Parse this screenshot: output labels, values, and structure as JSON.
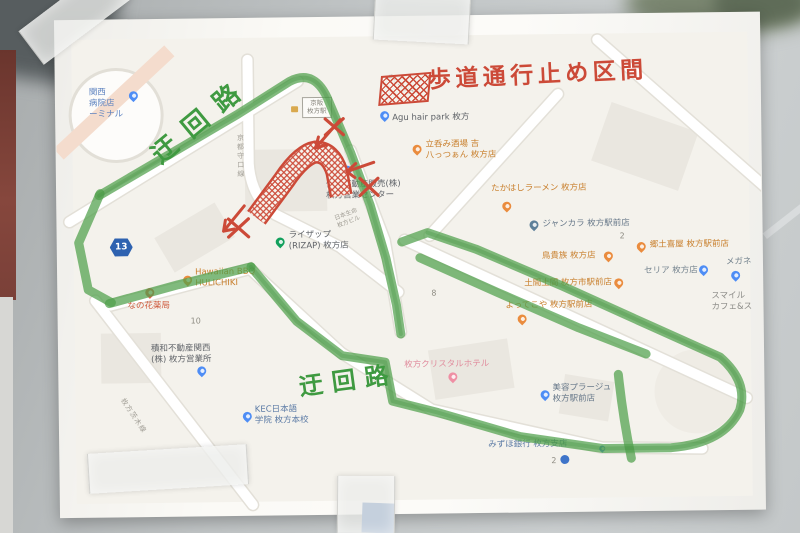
{
  "annotations": {
    "title": "歩道通行止め区間",
    "detour_top": "迂回路",
    "detour_bottom": "迂回路",
    "marker_green": "#4f9f4b",
    "marker_red": "#cc4a38"
  },
  "map": {
    "route_shield": "13",
    "road_names": {
      "keito_moriguchi": "京都守口線",
      "hirakata_ibaraki": "枚方茨木線"
    },
    "station_box": [
      "京阪",
      "枚方駅"
    ],
    "block_numbers": {
      "a": "10",
      "b": "8",
      "c": "2",
      "d": "2"
    },
    "clinic": "クリニック",
    "pois": [
      {
        "id": "terminal",
        "lines": [
          "関西",
          "病院店",
          "ーミナル"
        ]
      },
      {
        "id": "agu-hair-park",
        "lines": [
          "Agu hair park 枚方"
        ]
      },
      {
        "id": "hattsuan",
        "lines": [
          "立呑み酒場 吉",
          "八っつぁん 枚方店"
        ]
      },
      {
        "id": "takahashi-ramen",
        "lines": [
          "たかはしラーメン 枚方店"
        ]
      },
      {
        "id": "jankara",
        "lines": [
          "ジャンカラ 枚方駅前店"
        ]
      },
      {
        "id": "torikizoku",
        "lines": [
          "鳥貴族 枚方店"
        ]
      },
      {
        "id": "domadoma",
        "lines": [
          "土間土間 枚方市駅前店"
        ]
      },
      {
        "id": "yottekoya",
        "lines": [
          "よってこや 枚方駅前店"
        ]
      },
      {
        "id": "kyodo-izakaya",
        "lines": [
          "郷土喜屋 枚方駅前店"
        ]
      },
      {
        "id": "seria",
        "lines": [
          "セリア 枚方店"
        ]
      },
      {
        "id": "megane",
        "lines": [
          "メガネ"
        ]
      },
      {
        "id": "smile-cafe",
        "lines": [
          "スマイル",
          "カフェ&ス"
        ]
      },
      {
        "id": "sumitomo-fudosan",
        "lines": [
          "住友不動産販売(株)",
          "枚方営業センター"
        ]
      },
      {
        "id": "rizap",
        "lines": [
          "ライザップ",
          "(RIZAP) 枚方店"
        ]
      },
      {
        "id": "nissay-bldg",
        "lines": [
          "日本生命",
          "枚方ビル"
        ]
      },
      {
        "id": "nanohana-pharmacy",
        "lines": [
          "なの花薬局"
        ]
      },
      {
        "id": "hawaiian-bbq",
        "lines": [
          "Hawaiian BBQ",
          "HULICHIKI"
        ]
      },
      {
        "id": "sekiwa-fudosan",
        "lines": [
          "積和不動産関西",
          "(株) 枚方営業所"
        ]
      },
      {
        "id": "kec",
        "lines": [
          "KEC日本語",
          "学院 枚方本校"
        ]
      },
      {
        "id": "crystal-hotel",
        "lines": [
          "枚方クリスタルホテル"
        ]
      },
      {
        "id": "plage",
        "lines": [
          "美容プラージュ",
          "枚方駅前店"
        ]
      },
      {
        "id": "mizuho",
        "lines": [
          "みずほ銀行 枚方支店"
        ]
      }
    ]
  }
}
